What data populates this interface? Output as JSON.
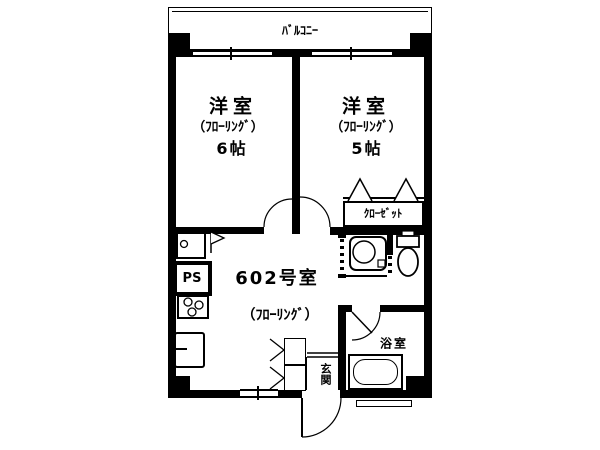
{
  "floorplan": {
    "labels": {
      "balcony": "ﾊﾞﾙｺﾆｰ",
      "bedroom1_name": "洋室",
      "bedroom1_floor": "（ﾌﾛｰﾘﾝｸﾞ）",
      "bedroom1_size": "6帖",
      "bedroom2_name": "洋室",
      "bedroom2_floor": "（ﾌﾛｰﾘﾝｸﾞ）",
      "bedroom2_size": "5帖",
      "closet": "ｸﾛｰｾﾞｯﾄ",
      "unit_number": "602号室",
      "unit_floor": "（ﾌﾛｰﾘﾝｸﾞ）",
      "bathroom": "浴室",
      "entrance": "玄関",
      "pipe_space": "PS"
    },
    "colors": {
      "line": "#000000",
      "background": "#ffffff"
    }
  }
}
